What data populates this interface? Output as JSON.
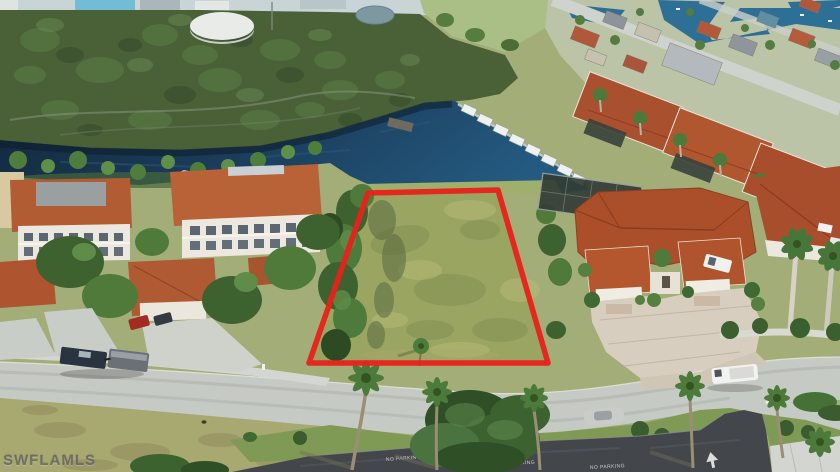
{
  "meta": {
    "type": "aerial-real-estate-photo",
    "subject": "Aerial drone photo of a waterfront vacant lot outlined in red, canal-front neighborhood with docks, palm-lined street and tile-roof homes"
  },
  "watermark": {
    "text": "SWFLAMLS"
  },
  "road_markings": {
    "no_parking_1": "NO PARKING",
    "no_parking_2": "NO PARKING",
    "no_parking_3": "NO PARKING"
  },
  "colors": {
    "boundary_red": "#e8211a",
    "canal_water": "#1c3f5e",
    "mangrove_green": "#4a6138",
    "lot_grass": "#9aa562",
    "roof_terracotta": "#ab4f2b",
    "road_gray": "#c6cac4",
    "asphalt_dark": "#43474b"
  }
}
